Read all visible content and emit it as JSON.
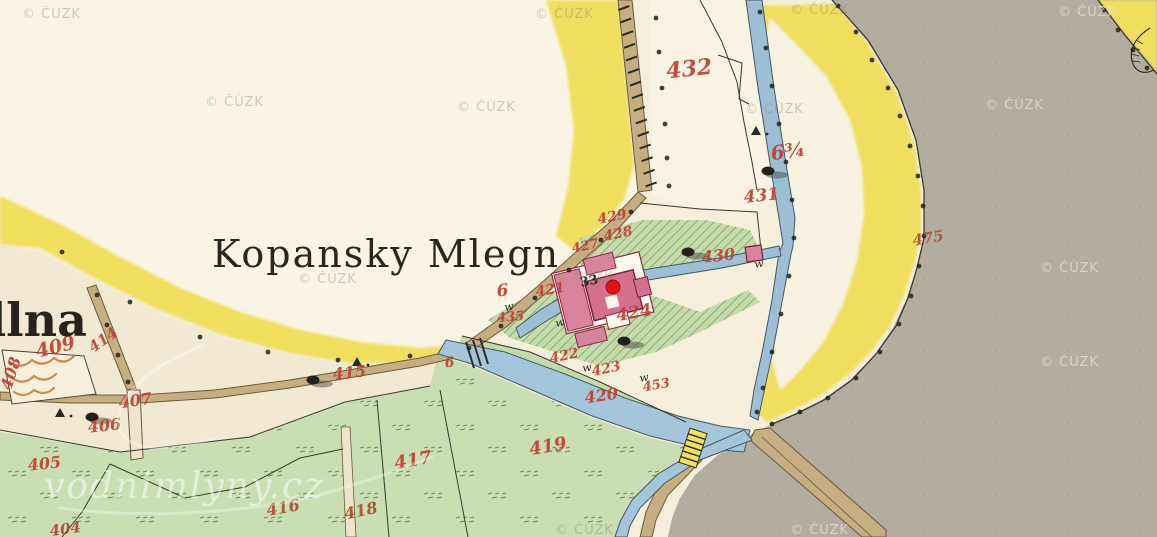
{
  "map": {
    "provider_watermark": "© ČÚZK",
    "logo_watermark": "vodnimlyny.cz",
    "title": "Kopansky Mlegn",
    "partial_place_name": "dlna",
    "house_number": {
      "label": "33",
      "x": 590,
      "y": 285,
      "rot": -12,
      "size": 13
    },
    "marker": {
      "x": 613,
      "y": 287,
      "r": 7,
      "color": "#e11414"
    },
    "colors": {
      "paper": "#f4eeda",
      "field": "#f9f4e4",
      "village": "#f1e9d2",
      "yellow_road": "#f0df5e",
      "water": "#a4c6da",
      "meadow": "#c9deb2",
      "meadow_hatched": "#c3dbaa",
      "road": "#c6ae82",
      "gray_area": "#b3ada0",
      "building_pink": "#d4708c",
      "building_outline": "#7d1f38",
      "number_red": "#bf4036",
      "ink": "#2a271f"
    },
    "parcel_labels": [
      {
        "label": "432",
        "x": 690,
        "y": 76,
        "rot": -6,
        "size": 22
      },
      {
        "label": "6¾",
        "x": 789,
        "y": 158,
        "rot": -8,
        "size": 20
      },
      {
        "label": "431",
        "x": 762,
        "y": 201,
        "rot": -6,
        "size": 17
      },
      {
        "label": "475",
        "x": 929,
        "y": 243,
        "rot": -10,
        "size": 15,
        "color": "#a8572e"
      },
      {
        "label": "429",
        "x": 613,
        "y": 221,
        "rot": -12,
        "size": 14
      },
      {
        "label": "428",
        "x": 619,
        "y": 238,
        "rot": -12,
        "size": 14
      },
      {
        "label": "427",
        "x": 586,
        "y": 250,
        "rot": -12,
        "size": 13
      },
      {
        "label": "430",
        "x": 719,
        "y": 261,
        "rot": -6,
        "size": 16
      },
      {
        "label": "424",
        "x": 635,
        "y": 318,
        "rot": -10,
        "size": 17
      },
      {
        "label": "6",
        "x": 503,
        "y": 296,
        "rot": -5,
        "size": 17
      },
      {
        "label": "421",
        "x": 551,
        "y": 294,
        "rot": -10,
        "size": 14
      },
      {
        "label": "435",
        "x": 511,
        "y": 321,
        "rot": -5,
        "size": 13
      },
      {
        "label": "6",
        "x": 450,
        "y": 367,
        "rot": -5,
        "size": 14
      },
      {
        "label": "422",
        "x": 565,
        "y": 360,
        "rot": -12,
        "size": 14
      },
      {
        "label": "423",
        "x": 607,
        "y": 373,
        "rot": -12,
        "size": 14
      },
      {
        "label": "453",
        "x": 657,
        "y": 389,
        "rot": -10,
        "size": 13
      },
      {
        "label": "420",
        "x": 602,
        "y": 401,
        "rot": -8,
        "size": 16
      },
      {
        "label": "419",
        "x": 549,
        "y": 452,
        "rot": -10,
        "size": 18
      },
      {
        "label": "417",
        "x": 414,
        "y": 466,
        "rot": -10,
        "size": 18
      },
      {
        "label": "418",
        "x": 362,
        "y": 516,
        "rot": -12,
        "size": 16,
        "color": "#a2502f"
      },
      {
        "label": "416",
        "x": 284,
        "y": 513,
        "rot": -10,
        "size": 16,
        "color": "#a2502f"
      },
      {
        "label": "415",
        "x": 350,
        "y": 378,
        "rot": -6,
        "size": 16
      },
      {
        "label": "409",
        "x": 57,
        "y": 353,
        "rot": -14,
        "size": 19
      },
      {
        "label": "414",
        "x": 106,
        "y": 344,
        "rot": -35,
        "size": 15
      },
      {
        "label": "408",
        "x": 16,
        "y": 375,
        "rot": -72,
        "size": 16
      },
      {
        "label": "407",
        "x": 136,
        "y": 406,
        "rot": -8,
        "size": 16
      },
      {
        "label": "406",
        "x": 105,
        "y": 431,
        "rot": -6,
        "size": 16
      },
      {
        "label": "405",
        "x": 45,
        "y": 469,
        "rot": -6,
        "size": 16
      },
      {
        "label": "404",
        "x": 66,
        "y": 534,
        "rot": -8,
        "size": 15
      }
    ],
    "meadow_letters": [
      {
        "label": "w",
        "x": 505,
        "y": 311
      },
      {
        "label": "w",
        "x": 556,
        "y": 327
      },
      {
        "label": "w",
        "x": 583,
        "y": 372
      },
      {
        "label": "w",
        "x": 640,
        "y": 382
      },
      {
        "label": "w",
        "x": 755,
        "y": 268
      }
    ],
    "survey_triangles": [
      [
        357,
        363
      ],
      [
        60,
        414
      ],
      [
        756,
        132
      ]
    ],
    "bush_symbols": [
      [
        313,
        380
      ],
      [
        92,
        417
      ],
      [
        768,
        171
      ],
      [
        688,
        252
      ],
      [
        624,
        341
      ]
    ],
    "boundary_dots": [
      [
        62,
        252
      ],
      [
        130,
        302
      ],
      [
        200,
        337
      ],
      [
        268,
        352
      ],
      [
        338,
        360
      ],
      [
        410,
        356
      ],
      [
        760,
        12
      ],
      [
        766,
        48
      ],
      [
        772,
        86
      ],
      [
        779,
        124
      ],
      [
        786,
        162
      ],
      [
        792,
        200
      ],
      [
        794,
        238
      ],
      [
        789,
        276
      ],
      [
        781,
        314
      ],
      [
        772,
        352
      ],
      [
        763,
        388
      ],
      [
        757,
        412
      ],
      [
        838,
        6
      ],
      [
        856,
        32
      ],
      [
        872,
        60
      ],
      [
        888,
        88
      ],
      [
        900,
        116
      ],
      [
        910,
        146
      ],
      [
        918,
        176
      ],
      [
        923,
        206
      ],
      [
        924,
        236
      ],
      [
        919,
        266
      ],
      [
        911,
        296
      ],
      [
        899,
        324
      ],
      [
        880,
        352
      ],
      [
        856,
        378
      ],
      [
        828,
        398
      ],
      [
        800,
        412
      ],
      [
        772,
        424
      ],
      [
        1104,
        10
      ],
      [
        1118,
        30
      ],
      [
        1133,
        50
      ],
      [
        1147,
        68
      ],
      [
        656,
        18
      ],
      [
        659,
        52
      ],
      [
        662,
        88
      ],
      [
        665,
        124
      ],
      [
        667,
        158
      ],
      [
        669,
        186
      ],
      [
        631,
        212
      ],
      [
        601,
        240
      ],
      [
        569,
        270
      ],
      [
        535,
        298
      ],
      [
        501,
        326
      ],
      [
        469,
        348
      ],
      [
        97,
        295
      ],
      [
        107,
        325
      ],
      [
        118,
        355
      ],
      [
        128,
        382
      ]
    ],
    "cuzk_watermarks": [
      {
        "x": 22,
        "y": 18,
        "variant": "light"
      },
      {
        "x": 535,
        "y": 18,
        "variant": "light"
      },
      {
        "x": 790,
        "y": 14,
        "variant": "light"
      },
      {
        "x": 1058,
        "y": 16,
        "variant": "dark"
      },
      {
        "x": 205,
        "y": 106,
        "variant": "light"
      },
      {
        "x": 457,
        "y": 111,
        "variant": "light"
      },
      {
        "x": 745,
        "y": 113,
        "variant": "light"
      },
      {
        "x": 985,
        "y": 109,
        "variant": "dark"
      },
      {
        "x": 298,
        "y": 283,
        "variant": "light"
      },
      {
        "x": 555,
        "y": 281,
        "variant": "light"
      },
      {
        "x": 1040,
        "y": 272,
        "variant": "dark"
      },
      {
        "x": 1040,
        "y": 366,
        "variant": "dark"
      },
      {
        "x": 555,
        "y": 534,
        "variant": "light"
      },
      {
        "x": 790,
        "y": 534,
        "variant": "dark"
      }
    ]
  }
}
